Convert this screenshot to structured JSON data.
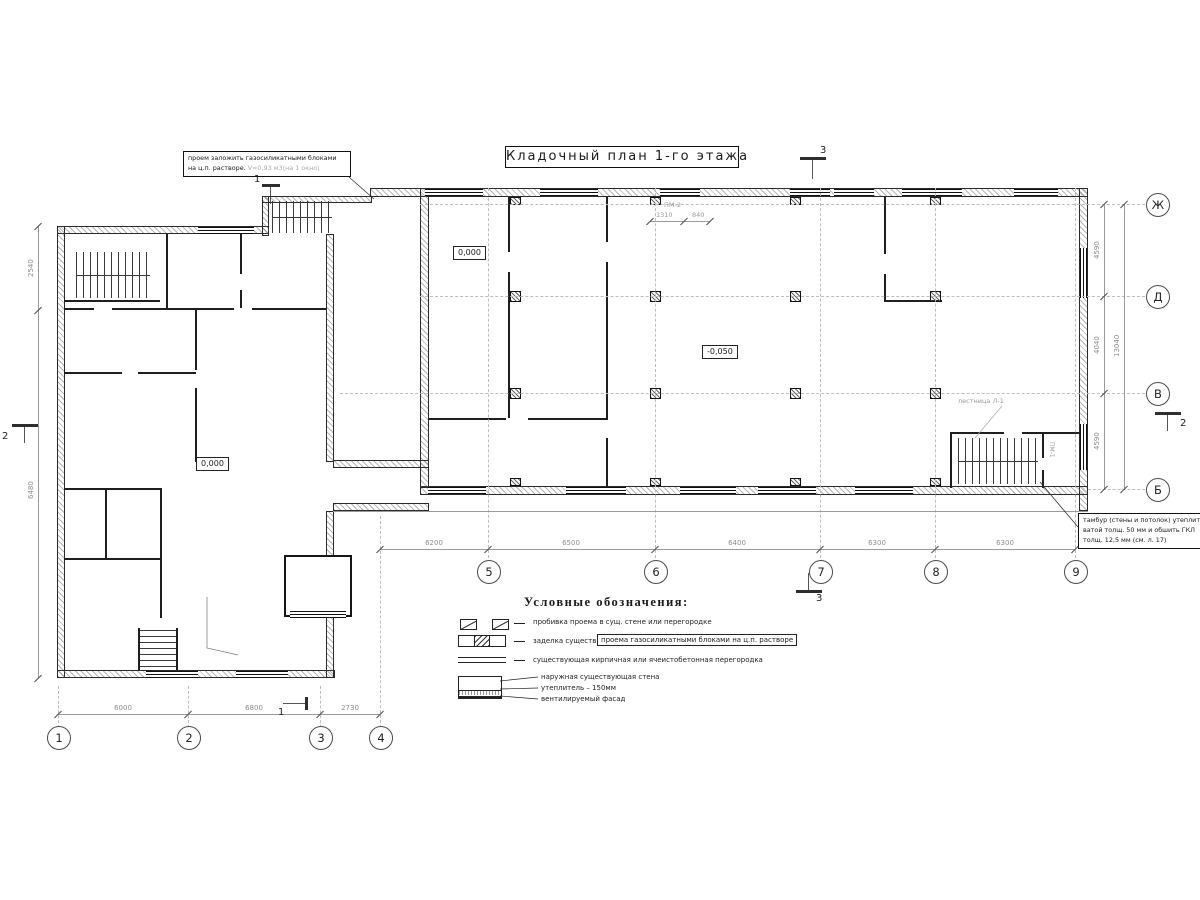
{
  "title": "Кладочный план 1-го этажа",
  "notes": {
    "opening": {
      "line1": "проем заложить газосиликатными блоками",
      "line2": "на ц.п. растворе.",
      "line2_detail": "V=0,93 м3(на 1 окно)"
    },
    "tambour": {
      "line1": "тамбур (стены и потолок) утеплить",
      "line2": "ватой толщ. 50 мм и обшить ГКЛ",
      "line3": "толщ. 12,5 мм (см. л. 17)"
    },
    "stair": "лестница Л-1",
    "door_top": "ПМ-2",
    "door_right": "ПМ-1"
  },
  "elevations": {
    "hall_entry": "0,000",
    "hall": "-0,050",
    "left_wing": "0,000"
  },
  "legend": {
    "heading": "Условные обозначения:",
    "row1": "пробивка проема  в сущ. стене  или перегородке",
    "row2_plain": "заделка существ.",
    "row2_boxed": "проема газосиликатными блоками на ц.п. растворе",
    "row3": "существующая кирпичная или ячеистобетонная перегородка",
    "wall_section": {
      "line1": "наружная существующая стена",
      "line2": "утеплитель – 150мм",
      "line3": "вентилируемый фасад"
    }
  },
  "axes": {
    "bottom_left": [
      "1",
      "2",
      "3",
      "4"
    ],
    "bottom_main": [
      "5",
      "6",
      "7",
      "8",
      "9"
    ],
    "right": [
      "Ж",
      "Д",
      "В",
      "Б"
    ]
  },
  "dims": {
    "bottom_left": [
      "6000",
      "6800",
      "2730"
    ],
    "bottom_main": [
      "6200",
      "6500",
      "6400",
      "6300",
      "6300"
    ],
    "right": [
      "4590",
      "4040",
      "4590"
    ],
    "right_total": "13040",
    "left": [
      "2540",
      "6480"
    ],
    "door_top": [
      "1310",
      "840"
    ]
  },
  "sections": {
    "s1": "1",
    "s2": "2",
    "s3": "3"
  },
  "colors": {
    "line": "#1a1a1a",
    "dim": "#8d8d8d",
    "bg": "#ffffff"
  }
}
